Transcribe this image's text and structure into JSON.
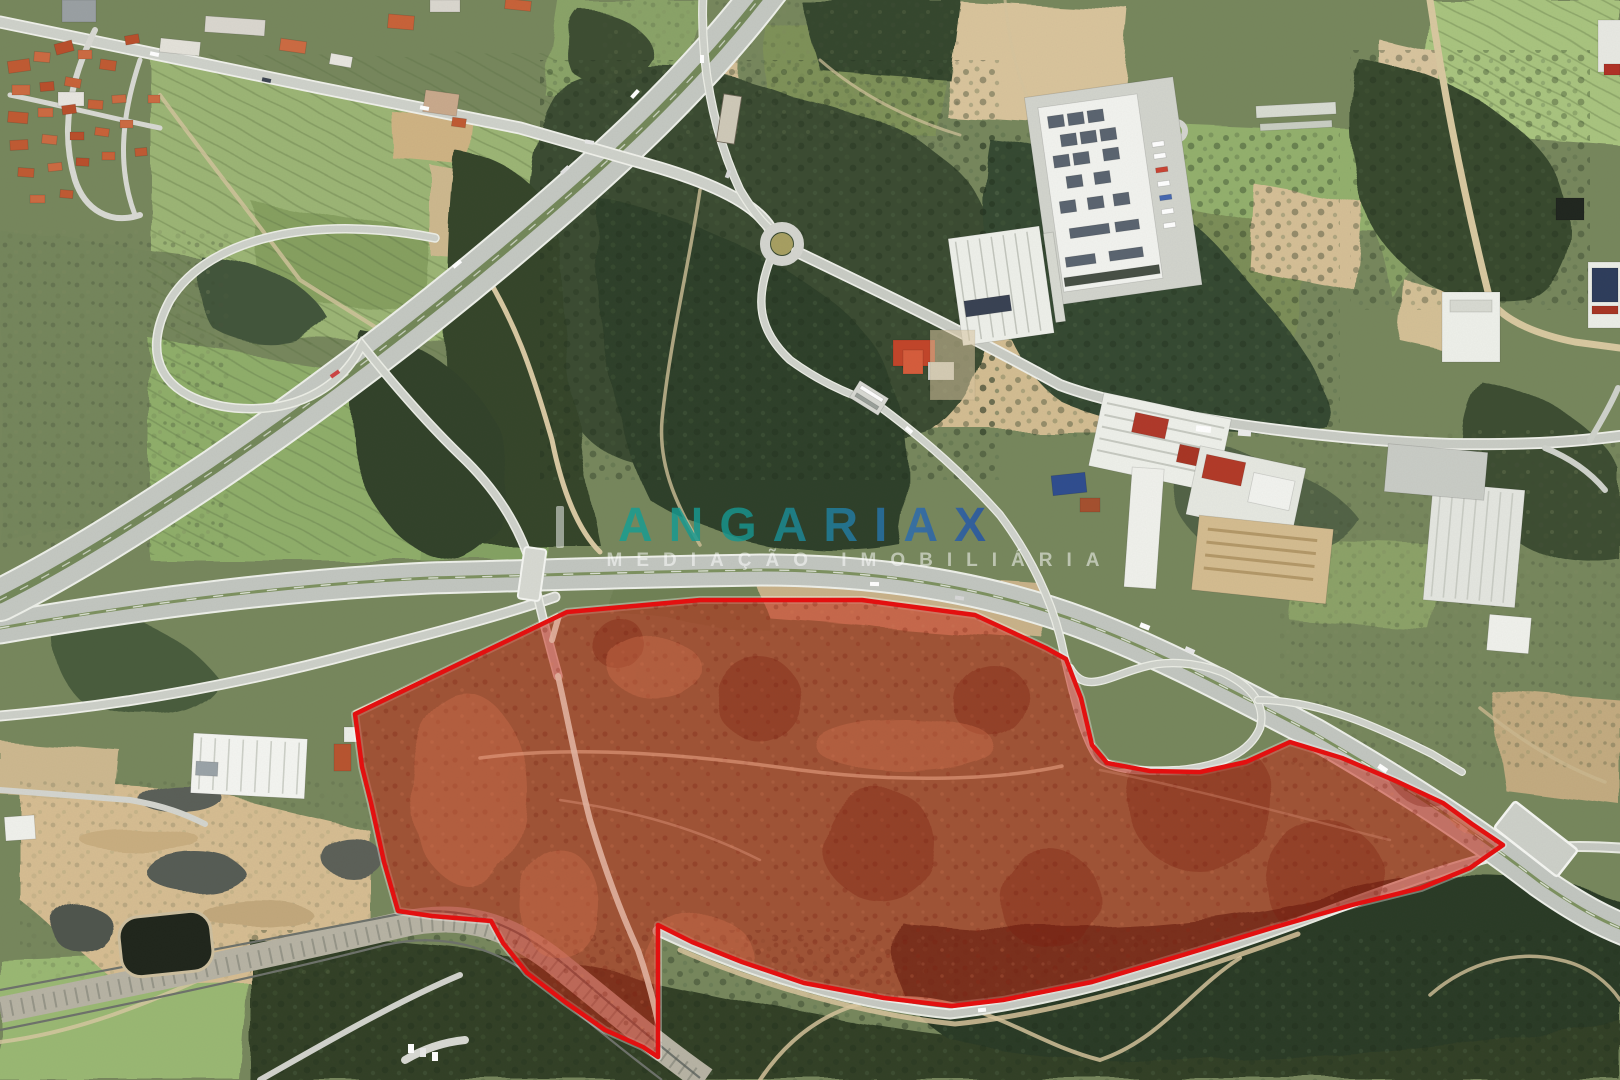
{
  "image_alt": "Aerial satellite photograph of a large land parcel outlined in red, bordered by a motorway interchange, industrial warehouses, a village and forest",
  "watermark": {
    "brand": "ANGARIAX",
    "tagline": "MEDIAÇÃO IMOBILIÁRIA",
    "brand_gradient_start": "#14a395",
    "brand_gradient_end": "#1c3fa0",
    "tagline_color": "#ffffff"
  },
  "overlay": {
    "label": "property-boundary",
    "stroke_color": "#e60f0f",
    "fill_color": "rgba(198,36,20,0.52)",
    "points": "355,714 567,612 700,600 862,600 975,615 1046,648 1066,659 1081,698 1092,745 1107,763 1150,771 1200,772 1246,762 1290,742 1342,758 1396,781 1443,803 1472,824 1503,845 1470,868 1421,888 1352,905 1272,928 1183,955 1092,982 1003,1000 952,1006 884,998 804,983 742,962 692,942 658,925 658,1057 643,1047 605,1030 565,1002 527,973 503,943 491,921 432,916 398,911 384,862 371,803 362,767"
  }
}
